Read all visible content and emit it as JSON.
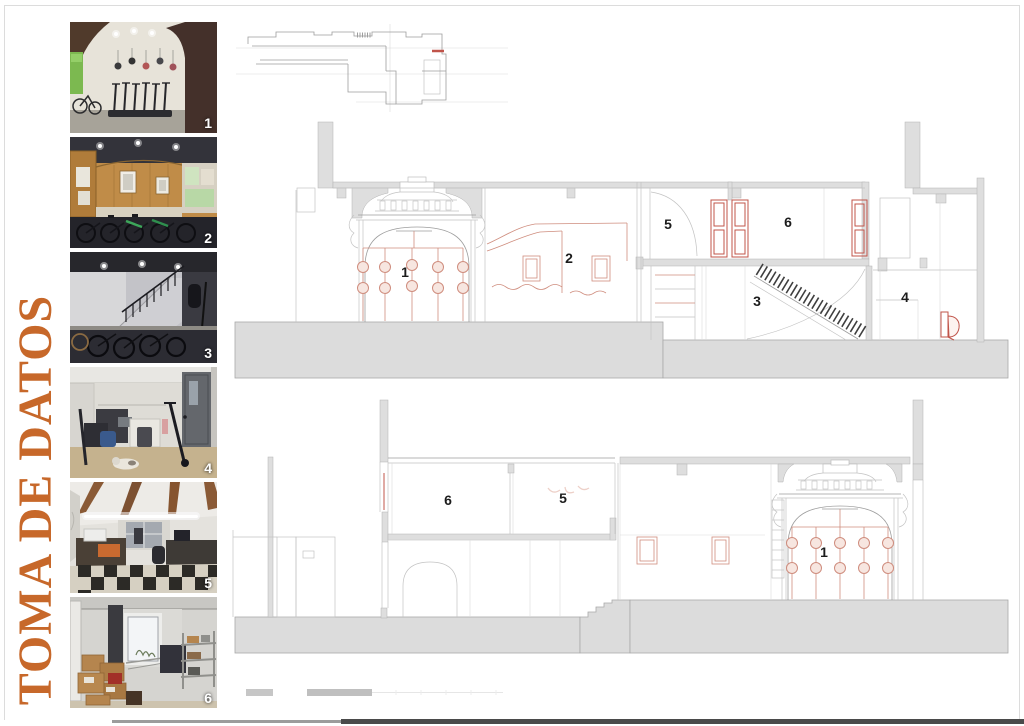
{
  "board": {
    "title": "TOMA DE DATOS"
  },
  "colors": {
    "accent_orange": "#c7682a",
    "drawing_poche_grey": "#dedede",
    "drawing_red": "#c0544a",
    "drawing_salmon": "#cf8d7e",
    "footer_grey": "#4a4a4a"
  },
  "photos": [
    {
      "number": "1",
      "scene": "entrance-arch-with-helmets-and-scooters"
    },
    {
      "number": "2",
      "scene": "wood-panelled-room-with-bicycles"
    },
    {
      "number": "3",
      "scene": "basement-stair-with-bicycles"
    },
    {
      "number": "4",
      "scene": "small-room-with-scooters-and-door"
    },
    {
      "number": "5",
      "scene": "office-beamed-ceiling-checkered-floor"
    },
    {
      "number": "6",
      "scene": "storage-room-with-boxes-and-shelving"
    }
  ],
  "sections": {
    "upper": {
      "room_labels": [
        "1",
        "2",
        "5",
        "6",
        "3",
        "4"
      ]
    },
    "lower": {
      "room_labels": [
        "6",
        "5",
        "1"
      ]
    }
  }
}
